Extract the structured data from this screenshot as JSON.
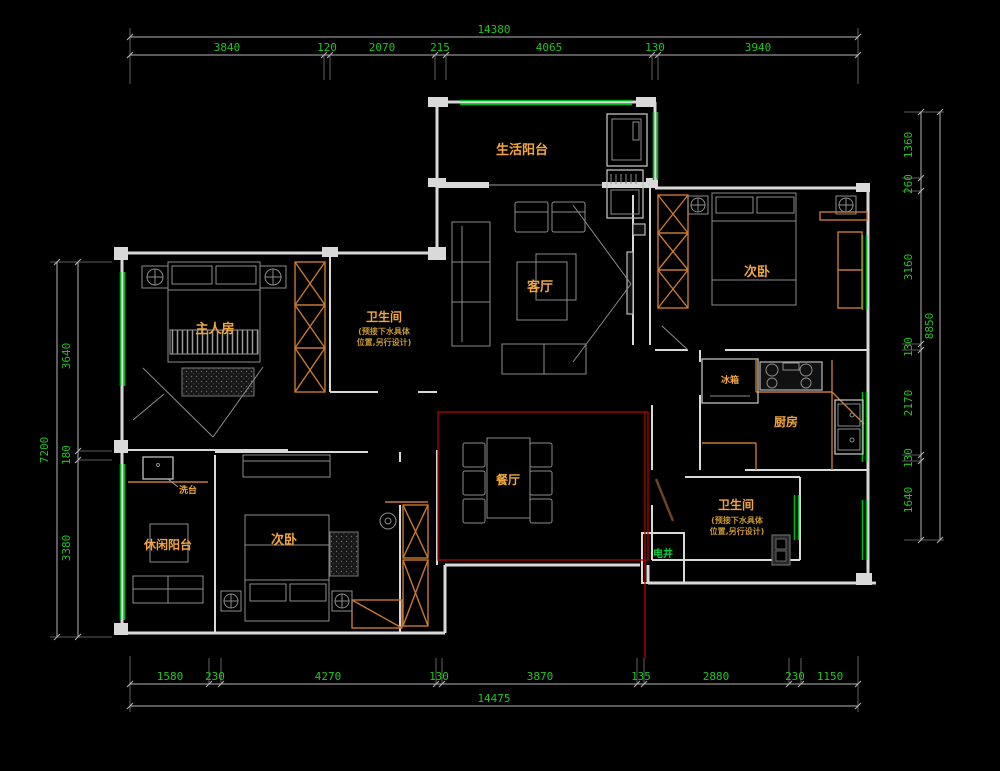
{
  "colors": {
    "bg": "#000000",
    "wall": "#d9d9d9",
    "dim": "#21c421",
    "win": "#00b41e",
    "label": "#f0a63c",
    "note": "#c8982c",
    "cab": "#c87830",
    "red": "#b40000",
    "shaft": "#00d43c",
    "furn": "#8c8c8c",
    "dline": "#b4b4b4"
  },
  "dimensions": {
    "top": {
      "total": "14380",
      "segments": [
        "3840",
        "120",
        "2070",
        "215",
        "4065",
        "130",
        "3940"
      ]
    },
    "bottom": {
      "total": "14475",
      "segments": [
        "1580",
        "230",
        "4270",
        "130",
        "3870",
        "135",
        "2880",
        "230",
        "1150"
      ]
    },
    "left": {
      "total": "7200",
      "segments": [
        "3640",
        "180",
        "3380"
      ]
    },
    "right": {
      "total": "8850",
      "segments": [
        "1360",
        "260",
        "3160",
        "130",
        "2170",
        "130",
        "1640"
      ]
    }
  },
  "rooms": {
    "life_balcony": "生活阳台",
    "living_room": "客厅",
    "bedroom_right": "次卧",
    "master_bedroom": "主人房",
    "bathroom_top": "卫生间",
    "bathroom_note_1": "(预接下水具体",
    "bathroom_note_2": "位置,另行设计)",
    "kitchen": "厨房",
    "fridge": "冰箱",
    "dining_room": "餐厅",
    "wash_counter": "洗台",
    "leisure_balcony": "休闲阳台",
    "bedroom_bottom": "次卧",
    "bathroom_bottom": "卫生间",
    "electric_shaft": "电井"
  }
}
